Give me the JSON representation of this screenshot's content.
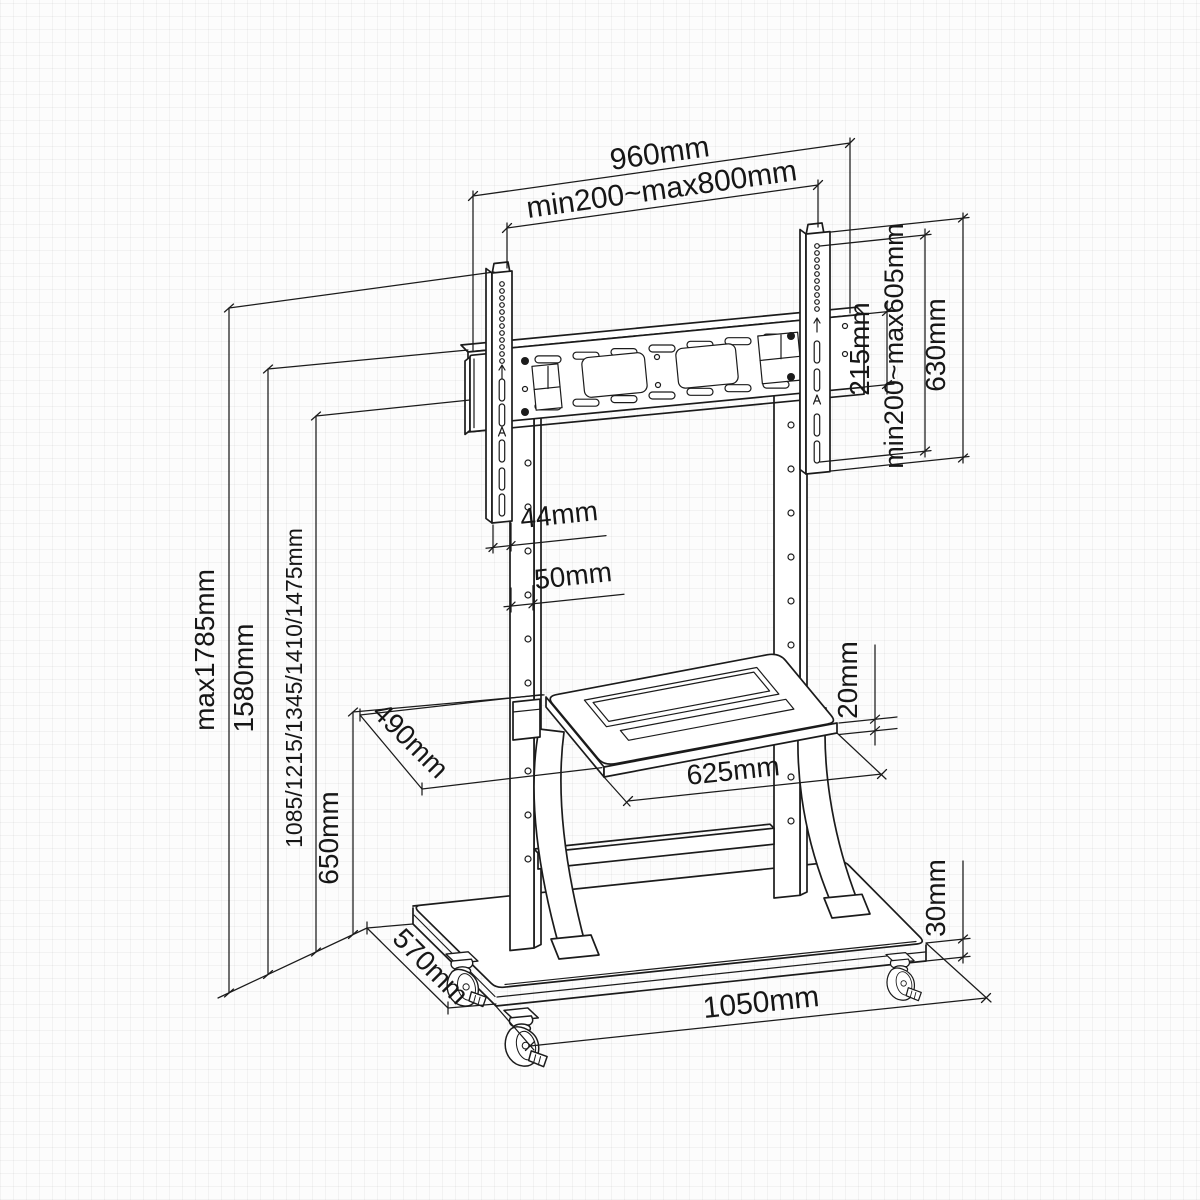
{
  "document": {
    "type": "technical-dimension-drawing",
    "subject": "Mobile TV floor stand with VESA mount bracket, shelf and casters"
  },
  "colors": {
    "line": "#1b1b1b",
    "label_text": "#161616",
    "background": "#fcfcfc"
  },
  "dims": {
    "overall_width": "960mm",
    "vesa_width_range": "min200~max800mm",
    "bracket_plate_height": "215mm",
    "vesa_height_range": "min200~max605mm",
    "rail_height": "630mm",
    "rail_width": "44mm",
    "column_width": "50mm",
    "shelf_depth": "490mm",
    "shelf_width": "625mm",
    "shelf_thickness": "20mm",
    "overall_height_max": "max1785mm",
    "bracket_top_height": "1580mm",
    "height_settings": "1085/1215/1345/1410/1475mm",
    "shelf_height": "650mm",
    "base_depth": "570mm",
    "base_width": "1050mm",
    "base_thickness": "30mm"
  }
}
